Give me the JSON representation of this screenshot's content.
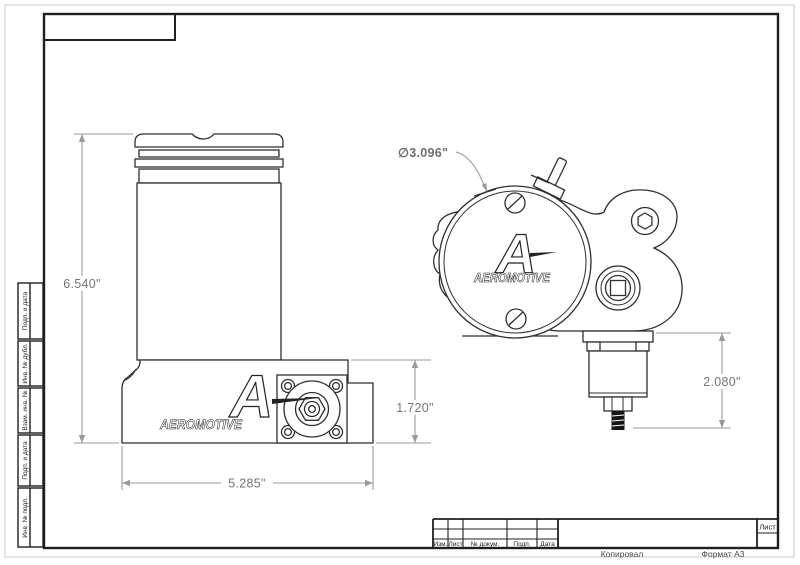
{
  "dimensions": {
    "overall_height": "6.540\"",
    "overall_width": "5.285\"",
    "base_height": "1.720\"",
    "housing_diameter": "∅3.096\"",
    "outlet_port_height": "2.080\""
  },
  "logo": {
    "initial": "A",
    "brand": "AEROMOTIVE"
  },
  "sidebar": {
    "cells": [
      {
        "label": "Подп. и дата"
      },
      {
        "label": "Инв. № дубл."
      },
      {
        "label": "Взам. инв. №"
      },
      {
        "label": "Подп. и дата"
      },
      {
        "label": "Инв. № подл."
      }
    ]
  },
  "title_block": {
    "columns": [
      {
        "label": "Изм."
      },
      {
        "label": "Лист"
      },
      {
        "label": "№ докум."
      },
      {
        "label": "Подп."
      },
      {
        "label": "Дата"
      }
    ],
    "sheet_label": "Лист"
  },
  "footer": {
    "copied_label": "Копировал",
    "format_label": "Формат А3"
  }
}
